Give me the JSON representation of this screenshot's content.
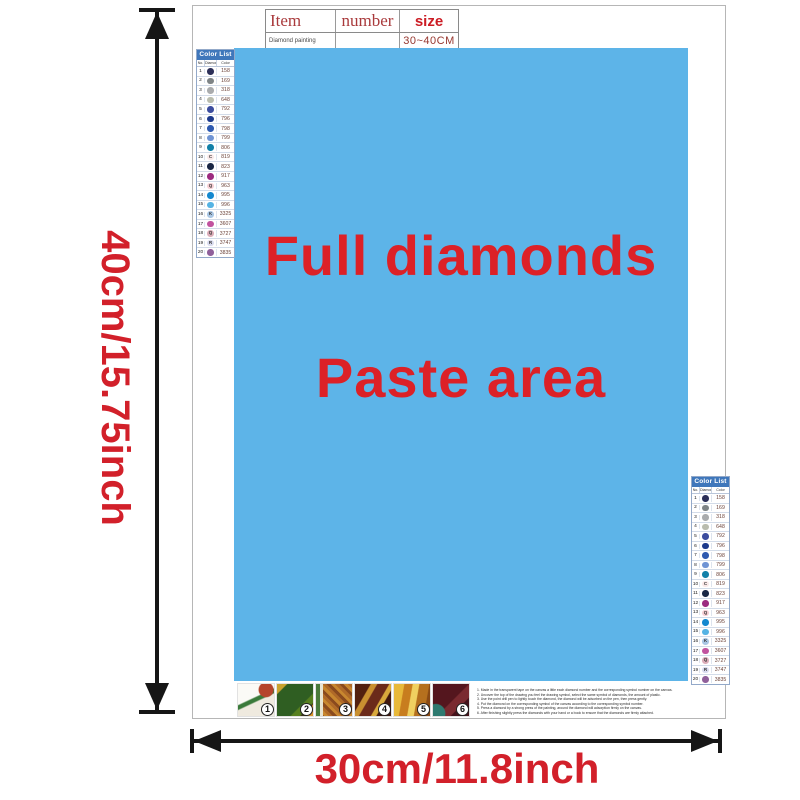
{
  "item_table": {
    "headers": [
      "Item",
      "number",
      "size"
    ],
    "row": {
      "item": "Diamond painting",
      "number": "",
      "size": "30~40CM"
    }
  },
  "paste_area": {
    "line1": "Full diamonds",
    "line2": "Paste area"
  },
  "dimensions": {
    "height_label": "40cm/15.75inch",
    "width_label": "30cm/11.8inch"
  },
  "color_list": {
    "title": "Color List",
    "columns": [
      "No.",
      "Diamond",
      "Color"
    ],
    "rows": [
      {
        "no": "1",
        "code": "158",
        "color": "#2c2f58",
        "sym": ""
      },
      {
        "no": "2",
        "code": "169",
        "color": "#7e8486",
        "sym": ""
      },
      {
        "no": "3",
        "code": "318",
        "color": "#a9abad",
        "sym": ""
      },
      {
        "no": "4",
        "code": "648",
        "color": "#b9bcae",
        "sym": ""
      },
      {
        "no": "5",
        "code": "792",
        "color": "#3c4d9f",
        "sym": ""
      },
      {
        "no": "6",
        "code": "796",
        "color": "#1d3a8c",
        "sym": ""
      },
      {
        "no": "7",
        "code": "798",
        "color": "#2e5ab0",
        "sym": ""
      },
      {
        "no": "8",
        "code": "799",
        "color": "#6f94d4",
        "sym": ""
      },
      {
        "no": "9",
        "code": "806",
        "color": "#1180a8",
        "sym": ""
      },
      {
        "no": "10",
        "code": "819",
        "color": "#f9e8e8",
        "sym": "C",
        "light": true
      },
      {
        "no": "11",
        "code": "823",
        "color": "#1a2744",
        "sym": ""
      },
      {
        "no": "12",
        "code": "917",
        "color": "#9c2b80",
        "sym": ""
      },
      {
        "no": "13",
        "code": "963",
        "color": "#f6ced3",
        "sym": "Q",
        "light": true
      },
      {
        "no": "14",
        "code": "995",
        "color": "#1488cf",
        "sym": ""
      },
      {
        "no": "15",
        "code": "996",
        "color": "#55b3e4",
        "sym": ""
      },
      {
        "no": "16",
        "code": "3325",
        "color": "#a9c6e4",
        "sym": "K",
        "light": true
      },
      {
        "no": "17",
        "code": "3607",
        "color": "#c2539f",
        "sym": ""
      },
      {
        "no": "18",
        "code": "3727",
        "color": "#dcadb9",
        "sym": "Q",
        "light": true
      },
      {
        "no": "19",
        "code": "3747",
        "color": "#d8dbef",
        "sym": "R",
        "light": true
      },
      {
        "no": "20",
        "code": "3835",
        "color": "#90609b",
        "sym": ""
      }
    ]
  },
  "steps": [
    {
      "num": "1"
    },
    {
      "num": "2"
    },
    {
      "num": "3"
    },
    {
      "num": "4"
    },
    {
      "num": "5"
    },
    {
      "num": "6"
    }
  ],
  "instructions": [
    "1. Made in the transparent tape on the canvas a little each diamond number and the corresponding symbol number on the canvas.",
    "2. Uncover the top of the drawing you feel the drawing symbol, select the same symbol of diamonds, the amount of plastic.",
    "3. Use the point drill pen to lightly touch the diamond, the diamond will be adsorbed on the pen, then press gently.",
    "4. Put the diamond on the corresponding symbol of the canvas according to the corresponding symbol number.",
    "5. Press a diamond by a strong press of the painting, around the diamond will adsorption firmly on the canvas.",
    "6. After finishing slightly press the diamonds with your hand or a book to ensure that the diamonds are firmly attached."
  ],
  "colors": {
    "paste_area_blue": "#5db4e8",
    "main_red": "#dc2127",
    "dimension_red": "#d2202a",
    "table_size_red": "#cc1c24",
    "table_header_red": "#a93a3c",
    "colorlist_header_blue": "#3f77bb",
    "arrow_black": "#161616"
  }
}
